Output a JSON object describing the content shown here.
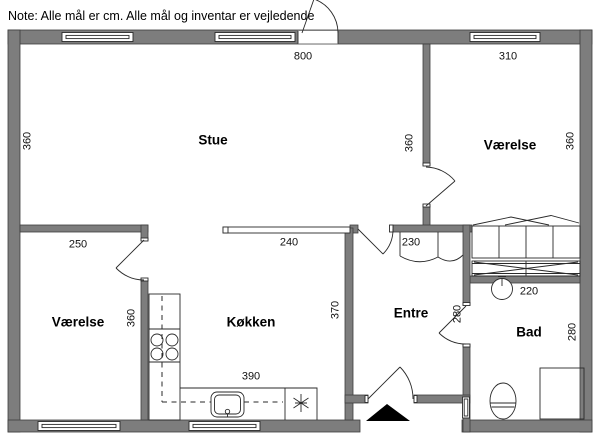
{
  "note": {
    "text": "Note: Alle mål er cm. Alle mål og inventar er vejledende"
  },
  "unit": "cm",
  "rooms": {
    "stue": "Stue",
    "vaerelse_ne": "Værelse",
    "vaerelse_sw": "Værelse",
    "koekken": "Køkken",
    "entre": "Entre",
    "bad": "Bad"
  },
  "dimensions_cm": {
    "stue_width": "800",
    "vaerelse_ne_width": "310",
    "stue_left_depth": "360",
    "stue_right_depth": "360",
    "vaerelse_ne_depth": "360",
    "vaerelse_sw_width": "250",
    "counter_length": "240",
    "entre_closet_width": "230",
    "bad_sink_wall": "220",
    "vaerelse_sw_depth": "360",
    "koekken_depth": "370",
    "entre_bad_door_wall": "280",
    "bad_depth": "280",
    "koekken_width": "390"
  },
  "fixtures": [
    "window-icon",
    "door-swing-icon",
    "stove-icon",
    "kitchen-sink-icon",
    "dishwasher-icon",
    "kitchen-counter",
    "wardrobe-icon",
    "closet-icon",
    "washbasin-icon",
    "toilet-icon",
    "shower-icon",
    "radiator-icon",
    "entrance-arrow-icon"
  ],
  "colors": {
    "wall": "#7d7d7d",
    "wall_outline": "#3d3d3d",
    "line": "#2a2a2a",
    "background": "#ffffff",
    "entrance_marker": "#000000"
  }
}
